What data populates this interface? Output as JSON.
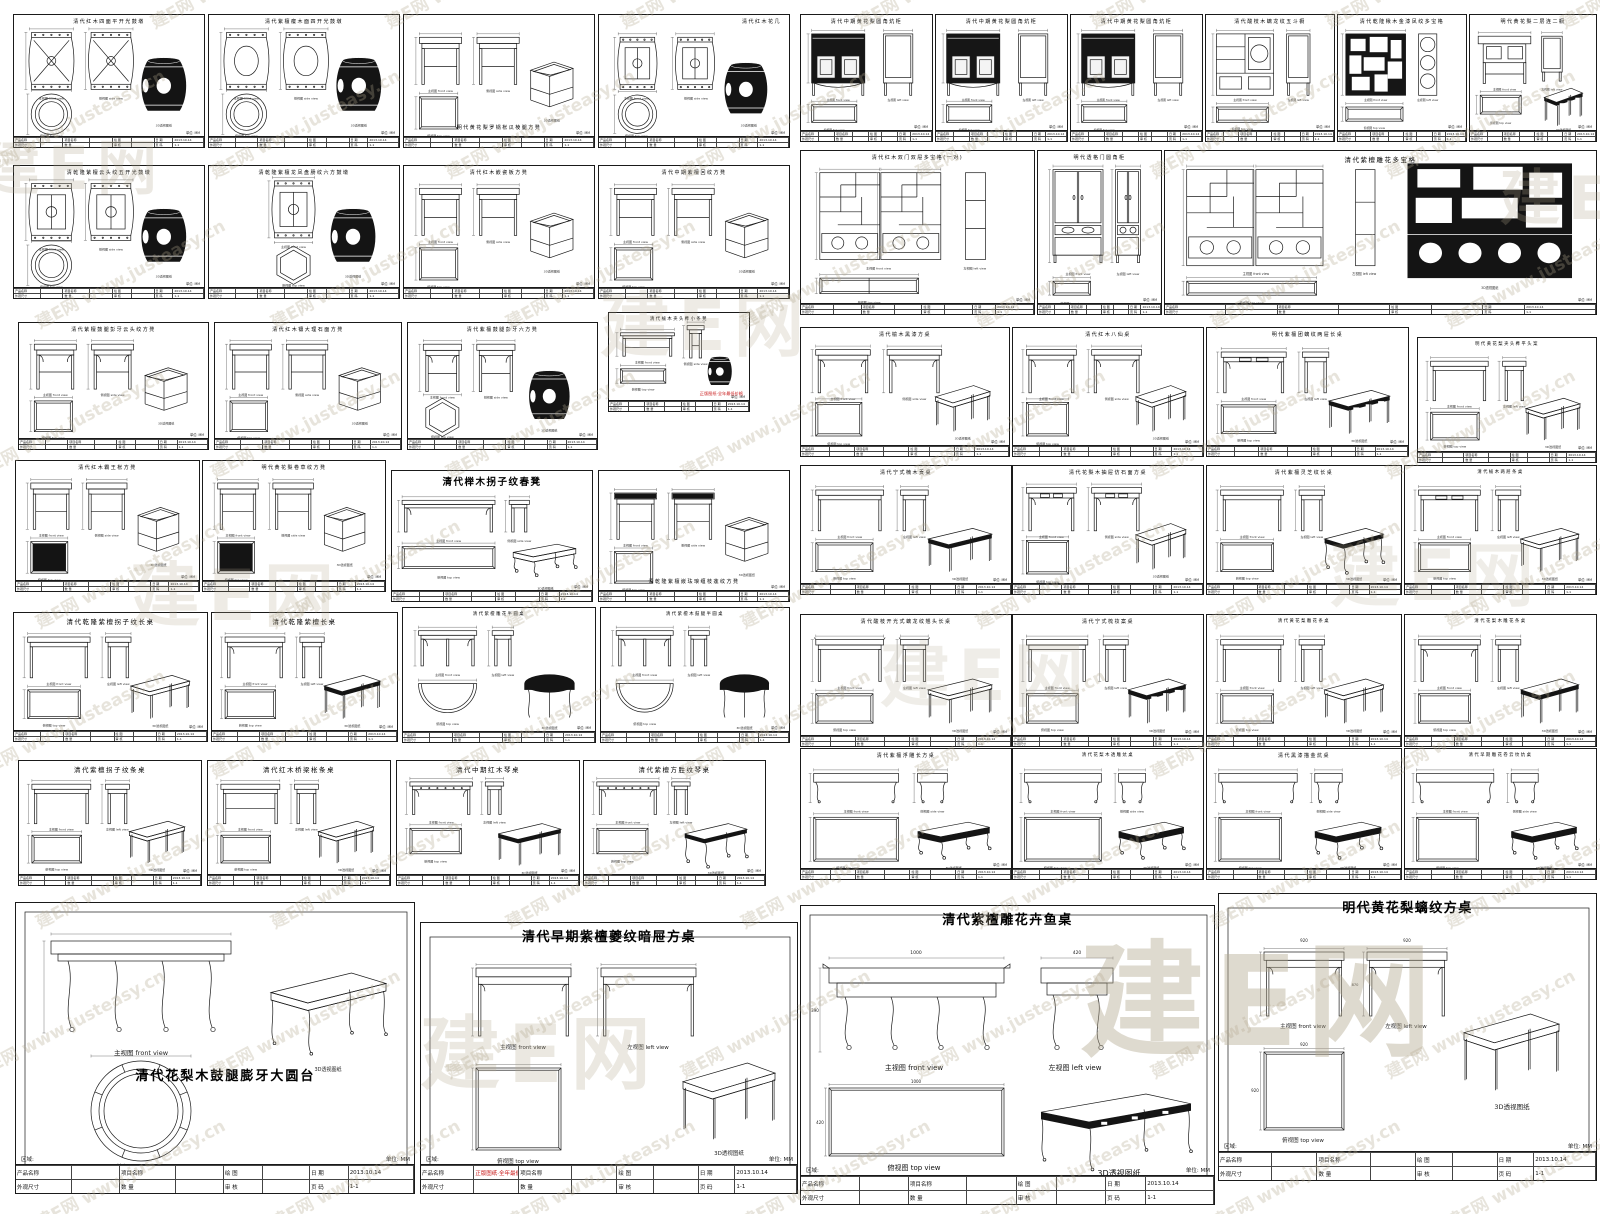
{
  "page": {
    "background": "#ffffff",
    "line_color": "#1a1a1a",
    "accent_red": "#c81616"
  },
  "watermark": {
    "tile": "建E网 www.justeasy.cn",
    "logo": "建E网",
    "color": "#b3a88e"
  },
  "labels": {
    "front": "主视图  front view",
    "left": "左视图  left view",
    "side": "侧视图  side view",
    "top": "俯视图  top view",
    "persp": "3D透视图纸",
    "unit": "单位: MM",
    "region": "区域:"
  },
  "titleblock": {
    "rows": [
      [
        "产品名称",
        "",
        "项目名称",
        "",
        "绘 图",
        "",
        "日 期",
        "2013.10.14"
      ],
      [
        "外观尺寸",
        "",
        "数 量",
        "",
        "审 核",
        "",
        "页 码",
        "1-1"
      ]
    ],
    "scale_label": "比 例",
    "scale": "1:1"
  },
  "red_note": "正版图纸·全年最低价格",
  "big": {
    "fish": {
      "w": "1000",
      "d": "420",
      "h": "390"
    },
    "ming": {
      "w": "920",
      "d": "920",
      "h": "870"
    }
  },
  "sheets": [
    {
      "x": 13,
      "y": 14,
      "w": 192,
      "h": 134,
      "k": "drum",
      "t": "清代红木四面平开光鼓墩",
      "ts": "t",
      "o": {
        "v": "x"
      }
    },
    {
      "x": 208,
      "y": 14,
      "w": 192,
      "h": 134,
      "k": "drum",
      "t": "清代紫檀瘿木面四开光鼓墩",
      "ts": "t",
      "o": {
        "v": "o"
      }
    },
    {
      "x": 403,
      "y": 14,
      "w": 192,
      "h": 134,
      "k": "sqstool",
      "t": "明代黄花梨罗锅枨瓜棱腿方凳",
      "ts": "t",
      "tp": "bottom",
      "o": {
        "cube": 1
      }
    },
    {
      "x": 598,
      "y": 14,
      "w": 192,
      "h": 134,
      "k": "drum",
      "t": "清代红木花几",
      "ts": "t",
      "tp": "topright",
      "o": {
        "v": "stand"
      }
    },
    {
      "x": 13,
      "y": 165,
      "w": 192,
      "h": 134,
      "k": "drum",
      "t": "清乾隆紫檀云头纹五开光鼓墩",
      "ts": "t",
      "o": {
        "v": "ornate"
      }
    },
    {
      "x": 208,
      "y": 165,
      "w": 192,
      "h": 134,
      "k": "hexdrum",
      "t": "清乾隆紫檀龙凤盘肠纹六方鼓墩",
      "ts": "t",
      "o": {}
    },
    {
      "x": 403,
      "y": 165,
      "w": 192,
      "h": 134,
      "k": "sqstool",
      "t": "清代红木嵌瓷板方凳",
      "ts": "t",
      "o": {}
    },
    {
      "x": 598,
      "y": 165,
      "w": 192,
      "h": 134,
      "k": "sqstool",
      "t": "清代中期紫檀回纹方凳",
      "ts": "t",
      "o": {
        "cube": 1
      }
    },
    {
      "x": 18,
      "y": 322,
      "w": 191,
      "h": 128,
      "k": "sqstool",
      "t": "清代紫檀鼓腿彭牙云头纹方凳",
      "ts": "t",
      "o": {
        "curvy": 1
      }
    },
    {
      "x": 214,
      "y": 322,
      "w": 188,
      "h": 128,
      "k": "sqstool",
      "t": "清代红木镶大理石面方凳",
      "ts": "t",
      "o": {}
    },
    {
      "x": 407,
      "y": 322,
      "w": 191,
      "h": 128,
      "k": "hexstool",
      "t": "清代紫檀鼓腿彭牙六方凳",
      "ts": "t",
      "o": {}
    },
    {
      "x": 608,
      "y": 312,
      "w": 142,
      "h": 100,
      "k": "minibench",
      "t": "清代榆木夹头榫小条凳",
      "ts": "tt",
      "o": {
        "red": 1
      }
    },
    {
      "x": 15,
      "y": 460,
      "w": 185,
      "h": 132,
      "k": "sqstool",
      "t": "清代红木霸王枨方凳",
      "ts": "t",
      "o": {
        "dkTop": 1
      }
    },
    {
      "x": 202,
      "y": 460,
      "w": 184,
      "h": 132,
      "k": "sqstool",
      "t": "明代黄花梨卷草纹方凳",
      "ts": "t",
      "o": {
        "dkTop": 1
      }
    },
    {
      "x": 391,
      "y": 470,
      "w": 202,
      "h": 132,
      "k": "bench",
      "t": "清代榉木拐子纹春凳",
      "ts": "lg",
      "o": {}
    },
    {
      "x": 598,
      "y": 470,
      "w": 192,
      "h": 132,
      "k": "sqstool",
      "t": "清乾隆紫檀嵌珐琅缠枝莲纹方凳",
      "ts": "t",
      "tp": "bottom",
      "o": {
        "dkFront": 1,
        "cube": 1
      }
    },
    {
      "x": 13,
      "y": 612,
      "w": 195,
      "h": 130,
      "k": "table",
      "t": "清代乾隆紫檀拐子纹长桌",
      "ts": "n",
      "o": {}
    },
    {
      "x": 211,
      "y": 612,
      "w": 187,
      "h": 130,
      "k": "table",
      "t": "清代乾隆紫檀长桌",
      "ts": "n",
      "o": {
        "orn": 1
      }
    },
    {
      "x": 402,
      "y": 607,
      "w": 194,
      "h": 136,
      "k": "halfround",
      "t": "清代紫檀雕花半圆桌",
      "ts": "tt",
      "o": {}
    },
    {
      "x": 600,
      "y": 607,
      "w": 190,
      "h": 136,
      "k": "halfround",
      "t": "清代紫檀木鼓腿半圆桌",
      "ts": "tt",
      "o": {}
    },
    {
      "x": 18,
      "y": 760,
      "w": 184,
      "h": 126,
      "k": "table",
      "t": "清代紫檀拐子纹条桌",
      "ts": "n",
      "o": {}
    },
    {
      "x": 207,
      "y": 760,
      "w": 184,
      "h": 126,
      "k": "table",
      "t": "清代红木桥梁枨条桌",
      "ts": "n",
      "o": {
        "str": 1
      }
    },
    {
      "x": 396,
      "y": 760,
      "w": 184,
      "h": 126,
      "k": "qintable",
      "t": "清代中期红木琴桌",
      "ts": "n",
      "o": {}
    },
    {
      "x": 583,
      "y": 760,
      "w": 183,
      "h": 126,
      "k": "qintable",
      "t": "清代紫檀方胜纹琴桌",
      "ts": "n",
      "o": {
        "v2": 1
      }
    },
    {
      "x": 15,
      "y": 902,
      "w": 400,
      "h": 292,
      "k": "big_round",
      "t": "清代花梨木鼓腿膨牙大圆台",
      "ts": "xl",
      "tp": "mid",
      "o": {}
    },
    {
      "x": 420,
      "y": 922,
      "w": 378,
      "h": 272,
      "k": "big_square",
      "t": "清代早期紫檀夔纹暗屉方桌",
      "ts": "xl",
      "o": {
        "redband": 1
      }
    },
    {
      "x": 800,
      "y": 14,
      "w": 133,
      "h": 128,
      "k": "kangcab",
      "t": "清代中期黄花梨圆角炕柜",
      "ts": "t",
      "o": {}
    },
    {
      "x": 935,
      "y": 14,
      "w": 133,
      "h": 128,
      "k": "kangcab",
      "t": "清代中期黄花梨圆角炕柜",
      "ts": "t",
      "o": {}
    },
    {
      "x": 1070,
      "y": 14,
      "w": 133,
      "h": 128,
      "k": "kangcab",
      "t": "清代中期黄花梨圆角炕柜",
      "ts": "t",
      "o": {}
    },
    {
      "x": 1205,
      "y": 14,
      "w": 130,
      "h": 128,
      "k": "chest",
      "t": "清代酸枝木螭龙纹五斗橱",
      "ts": "t",
      "o": {}
    },
    {
      "x": 1337,
      "y": 14,
      "w": 130,
      "h": 128,
      "k": "lattice",
      "t": "清代乾隆楸木金漆凤纹多宝格",
      "ts": "t",
      "o": {}
    },
    {
      "x": 1469,
      "y": 14,
      "w": 128,
      "h": 128,
      "k": "lianer",
      "t": "明代黄花梨二层连二橱",
      "ts": "t",
      "o": {}
    },
    {
      "x": 800,
      "y": 150,
      "w": 235,
      "h": 165,
      "k": "shelfpair",
      "t": "清代红木双门双屉多宝格(一对)",
      "ts": "t",
      "o": {}
    },
    {
      "x": 1037,
      "y": 150,
      "w": 125,
      "h": 165,
      "k": "wardrobe",
      "t": "明代透格门圆角柜",
      "ts": "t",
      "o": {}
    },
    {
      "x": 1164,
      "y": 150,
      "w": 433,
      "h": 165,
      "k": "shelfbig",
      "t": "清代紫檀雕花多宝格",
      "ts": "n",
      "o": {}
    },
    {
      "x": 800,
      "y": 327,
      "w": 210,
      "h": 130,
      "k": "sqtable",
      "t": "清代榆木黑漆方桌",
      "ts": "t",
      "o": {}
    },
    {
      "x": 1012,
      "y": 327,
      "w": 192,
      "h": 130,
      "k": "sqtable",
      "t": "清代红木八仙桌",
      "ts": "t",
      "o": {}
    },
    {
      "x": 1206,
      "y": 327,
      "w": 203,
      "h": 130,
      "k": "table",
      "t": "明代紫檀团螭纹两屉长桌",
      "ts": "t",
      "o": {
        "orn": 1,
        "dr": 1
      }
    },
    {
      "x": 1417,
      "y": 337,
      "w": 180,
      "h": 126,
      "k": "table",
      "t": "明代黄花梨夹头榫平头案",
      "ts": "tt",
      "o": {}
    },
    {
      "x": 800,
      "y": 465,
      "w": 212,
      "h": 130,
      "k": "table",
      "t": "清代宁式楠木贡桌",
      "ts": "t",
      "o": {
        "altar": 1
      }
    },
    {
      "x": 1012,
      "y": 465,
      "w": 192,
      "h": 130,
      "k": "sqtable",
      "t": "清代花梨木抽屉仿石面方桌",
      "ts": "t",
      "o": {
        "dr": 1
      }
    },
    {
      "x": 1206,
      "y": 465,
      "w": 196,
      "h": 130,
      "k": "table",
      "t": "清代紫檀灵芝纹长桌",
      "ts": "t",
      "o": {
        "carved": 1
      }
    },
    {
      "x": 1404,
      "y": 465,
      "w": 193,
      "h": 130,
      "k": "table",
      "t": "清代榆木两屉条桌",
      "ts": "tt",
      "o": {
        "dr": 1
      }
    },
    {
      "x": 800,
      "y": 614,
      "w": 212,
      "h": 133,
      "k": "table",
      "t": "清代酸枝开光式螭龙纹翘头长桌",
      "ts": "t",
      "o": {
        "qiao": 1
      }
    },
    {
      "x": 1012,
      "y": 614,
      "w": 192,
      "h": 133,
      "k": "table",
      "t": "清代宁式梳妆案桌",
      "ts": "t",
      "o": {
        "dress": 1
      }
    },
    {
      "x": 1206,
      "y": 614,
      "w": 196,
      "h": 133,
      "k": "table",
      "t": "清代黄花梨雕花条桌",
      "ts": "tt",
      "o": {}
    },
    {
      "x": 1404,
      "y": 614,
      "w": 193,
      "h": 133,
      "k": "table",
      "t": "清代花梨木雕花条桌",
      "ts": "tt",
      "o": {
        "orn": 1
      }
    },
    {
      "x": 800,
      "y": 748,
      "w": 212,
      "h": 132,
      "k": "kang",
      "t": "清代紫檀浮雕长方桌",
      "ts": "t",
      "o": {}
    },
    {
      "x": 1012,
      "y": 748,
      "w": 192,
      "h": 132,
      "k": "kang",
      "t": "清代花梨木透雕炕桌",
      "ts": "tt",
      "o": {}
    },
    {
      "x": 1206,
      "y": 748,
      "w": 196,
      "h": 132,
      "k": "kang",
      "t": "清代黑漆描金炕桌",
      "ts": "t",
      "o": {
        "sqtop": 1
      }
    },
    {
      "x": 1404,
      "y": 748,
      "w": 193,
      "h": 132,
      "k": "kang",
      "t": "清代早期雕花卷云纹炕桌",
      "ts": "tt",
      "o": {
        "sqtop": 1
      }
    },
    {
      "x": 800,
      "y": 905,
      "w": 415,
      "h": 300,
      "k": "big_fish",
      "t": "清代紫檀雕花卉鱼桌",
      "ts": "xl",
      "o": {}
    },
    {
      "x": 1218,
      "y": 893,
      "w": 379,
      "h": 288,
      "k": "big_ming",
      "t": "明代黄花梨螭纹方桌",
      "ts": "xl",
      "o": {}
    }
  ]
}
